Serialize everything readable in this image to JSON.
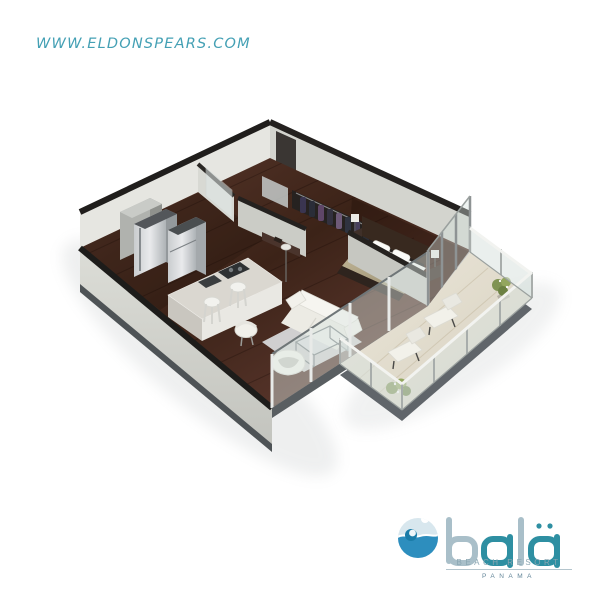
{
  "watermark": {
    "text": "WWW.ELDONSPEARS.COM",
    "color": "#3a9bb1"
  },
  "logo": {
    "wordmark": "balä",
    "line1": "BEACH RESORT",
    "line2": "PANAMA",
    "icon": "wave-icon",
    "colors": {
      "letter_light": "#a9bfc9",
      "letter_teal": "#2e8fa2",
      "wave_blue": "#2d8ebe",
      "wave_pale": "#d8e7ee"
    }
  },
  "scene": {
    "type": "isometric-3d-floor-plan",
    "subject": "one-bedroom apartment with wrap balcony",
    "rooms": [
      "kitchen",
      "bathroom",
      "closet",
      "hallway",
      "bedroom",
      "living-room",
      "balcony"
    ],
    "furniture": [
      "refrigerator",
      "tall-cabinet",
      "oven-tower",
      "kitchen-island",
      "bar-stools",
      "toilet",
      "vanity",
      "shower",
      "hanging-clothes",
      "desk",
      "double-bed",
      "nightstand-lamps",
      "sofa",
      "glass-coffee-table",
      "egg-armchair",
      "side-chair",
      "rug",
      "lounge-chairs",
      "potted-plants"
    ],
    "colors": {
      "wood_floor": "#46291f",
      "wall_face": "#d8d9d3",
      "wall_top": "#1f1d1b",
      "balcony_floor": "#e6e1d2",
      "glass": "#dce6e3",
      "bed_blanket": "#b3a98c"
    }
  }
}
